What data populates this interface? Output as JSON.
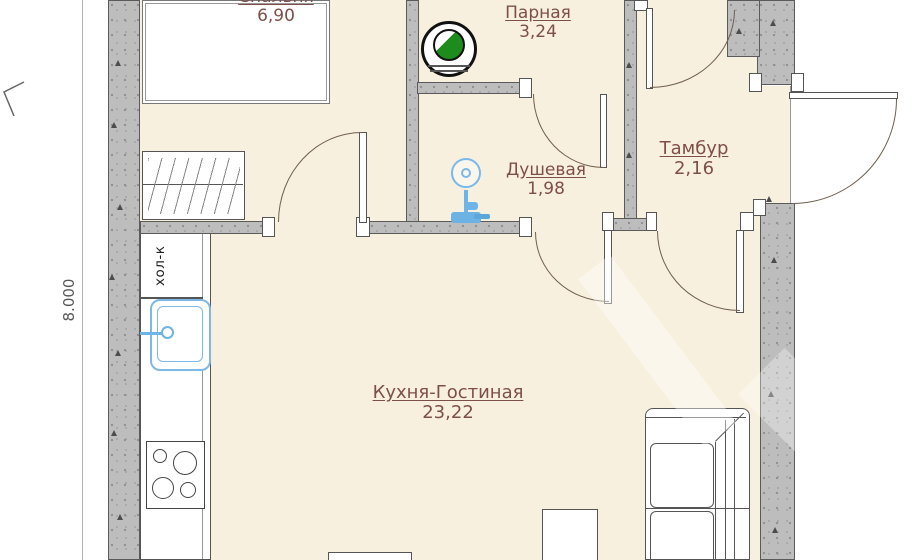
{
  "title": "floor-plan",
  "colors": {
    "floor": "#f8f0de",
    "wall": "#bdbdbd",
    "room_label": "#7e4f4a",
    "fixture_blue": "#6fb4e6",
    "stove_green": "#1d8c1d"
  },
  "rooms": [
    {
      "name": "Спальня",
      "area": "6,90"
    },
    {
      "name": "Парная",
      "area": "3,24"
    },
    {
      "name": "Душевая",
      "area": "1,98"
    },
    {
      "name": "Тамбур",
      "area": "2,16"
    },
    {
      "name": "Кухня-Гостиная",
      "area": "23,22"
    }
  ],
  "dimension_left": "8.000",
  "labels": {
    "fridge": "хол-к"
  },
  "icons": {
    "steam_stove": "sauna-stove-icon",
    "shower": "shower-icon",
    "sink": "sink-icon",
    "cooktop": "cooktop-icon",
    "wall_marks": "triangle"
  }
}
